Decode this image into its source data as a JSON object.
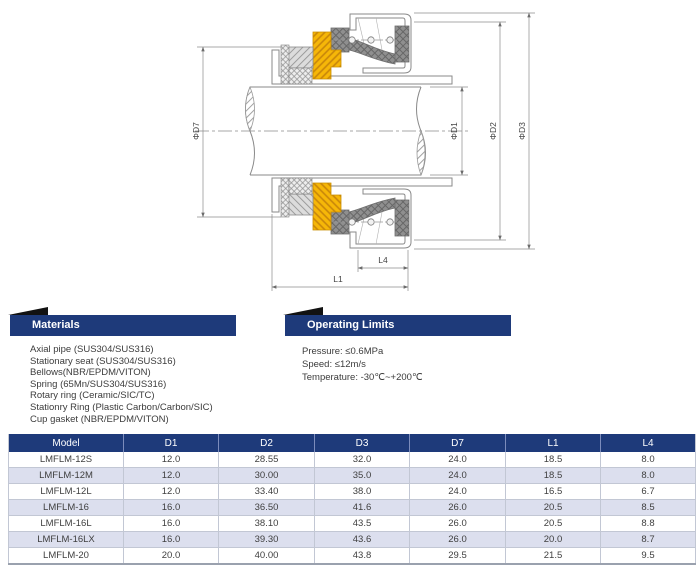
{
  "diagram": {
    "labels": {
      "d7": "ΦD7",
      "d1": "ΦD1",
      "d2": "ΦD2",
      "d3": "ΦD3",
      "l1": "L1",
      "l4": "L4"
    },
    "colors": {
      "rotary_ring": "#f6b708",
      "bellows": "#8f8f8f",
      "outline": "#8a8a8a",
      "dimension_lines": "#6b6b6b"
    }
  },
  "materials": {
    "title": "Materials",
    "items": [
      "Axial pipe (SUS304/SUS316)",
      "Stationary seat (SUS304/SUS316)",
      "Bellows(NBR/EPDM/VITON)",
      "Spring (65Mn/SUS304/SUS316)",
      "Rotary ring (Ceramic/SIC/TC)",
      "Stationry Ring (Plastic Carbon/Carbon/SIC)",
      "Cup gasket (NBR/EPDM/VITON)"
    ]
  },
  "operating_limits": {
    "title": "Operating Limits",
    "items": [
      "Pressure: ≤0.6MPa",
      "Speed: ≤12m/s",
      "Temperature: -30℃~+200℃"
    ]
  },
  "table": {
    "columns": [
      "Model",
      "D1",
      "D2",
      "D3",
      "D7",
      "L1",
      "L4"
    ],
    "rows": [
      [
        "LMFLM-12S",
        "12.0",
        "28.55",
        "32.0",
        "24.0",
        "18.5",
        "8.0"
      ],
      [
        "LMFLM-12M",
        "12.0",
        "30.00",
        "35.0",
        "24.0",
        "18.5",
        "8.0"
      ],
      [
        "LMFLM-12L",
        "12.0",
        "33.40",
        "38.0",
        "24.0",
        "16.5",
        "6.7"
      ],
      [
        "LMFLM-16",
        "16.0",
        "36.50",
        "41.6",
        "26.0",
        "20.5",
        "8.5"
      ],
      [
        "LMFLM-16L",
        "16.0",
        "38.10",
        "43.5",
        "26.0",
        "20.5",
        "8.8"
      ],
      [
        "LMFLM-16LX",
        "16.0",
        "39.30",
        "43.6",
        "26.0",
        "20.0",
        "8.7"
      ],
      [
        "LMFLM-20",
        "20.0",
        "40.00",
        "43.8",
        "29.5",
        "21.5",
        "9.5"
      ]
    ]
  },
  "colors": {
    "navy": "#1e3a7a",
    "row_alt": "#dcdfee"
  }
}
